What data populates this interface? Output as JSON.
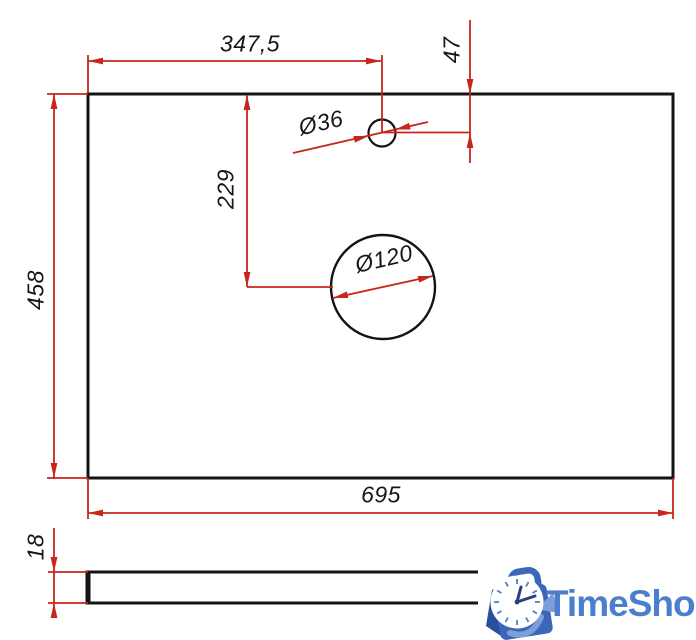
{
  "drawing": {
    "top_view": {
      "width": "695",
      "height": "458",
      "small_hole": {
        "diameter": "Ø36",
        "center_from_left": "347,5",
        "center_from_top": "47"
      },
      "large_hole": {
        "diameter": "Ø120",
        "center_offset_y": "229"
      }
    },
    "side_view": {
      "thickness": "18"
    }
  },
  "logo": {
    "text": "TimeShop",
    "icon": "shopping-bag-with-clock"
  },
  "colors": {
    "dimension_red": "#c8251d",
    "line_black": "#141414",
    "logo_blue": "#4b7fcb",
    "logo_bag_blue": "#3b67b8",
    "logo_bag_dark": "#2a4f9d",
    "logo_swoosh": "#7d9ed9",
    "logo_hands": "#23427e"
  }
}
